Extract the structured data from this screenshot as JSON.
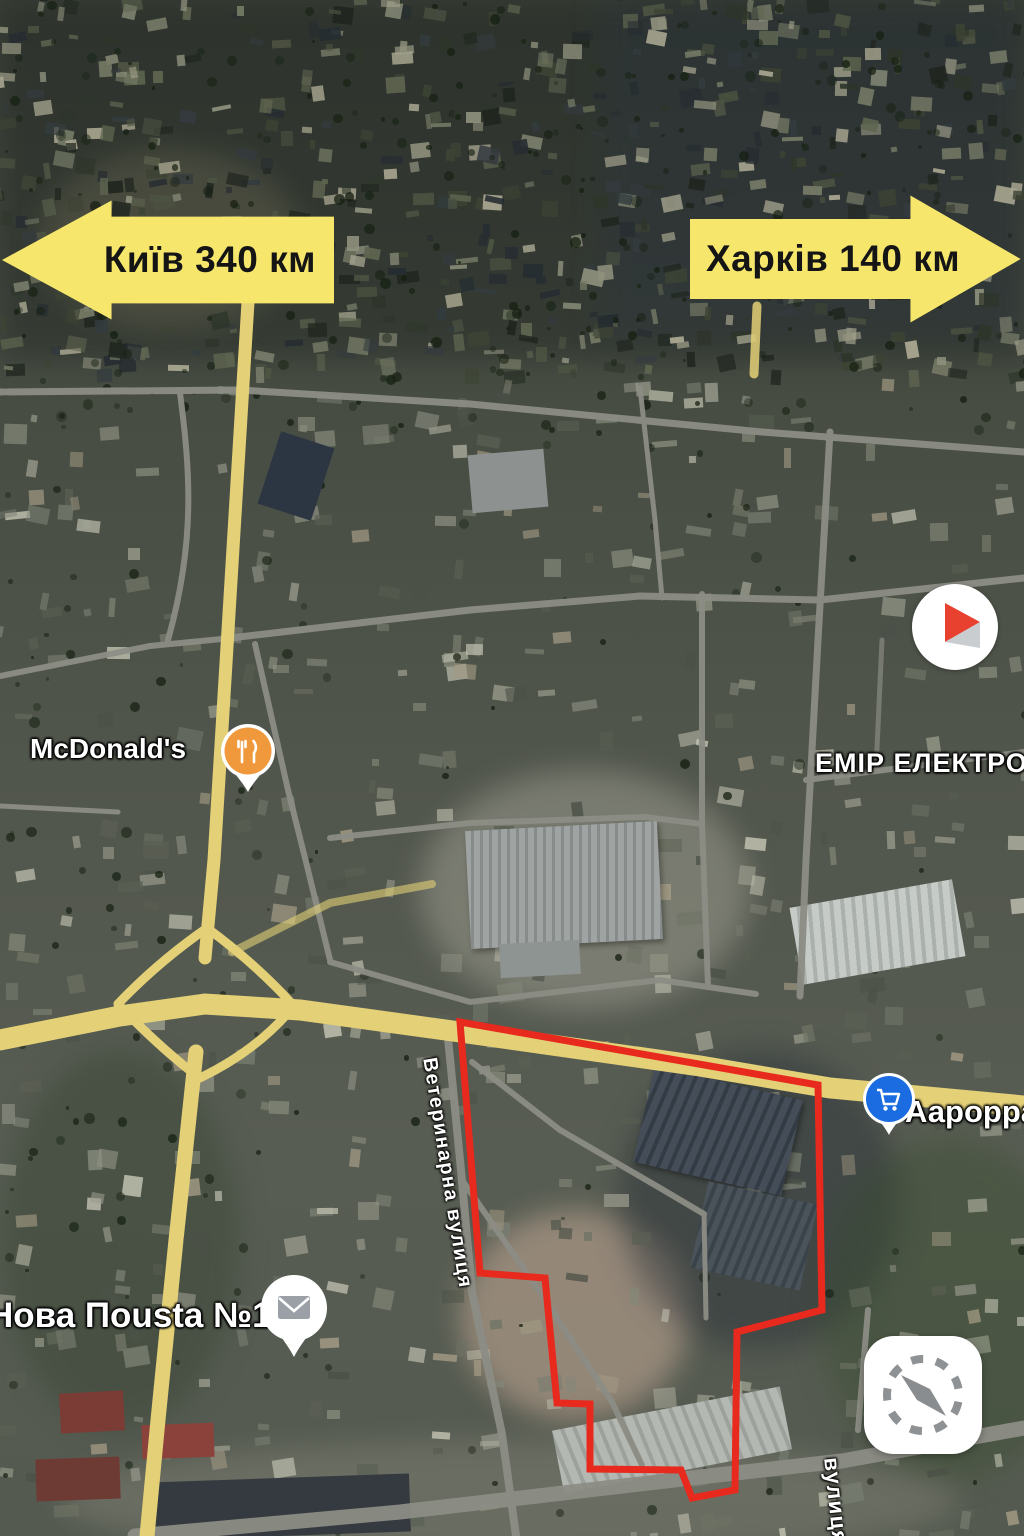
{
  "signs": {
    "kyiv": {
      "label": "Київ 340 км",
      "direction": "left"
    },
    "kharkiv": {
      "label": "Харків 140 км",
      "direction": "right"
    }
  },
  "pois": {
    "mcdonalds": {
      "label": "McDonald's",
      "icon": "restaurant-pin",
      "pin_color": "#f0993c"
    },
    "emir": {
      "label": "ЕМІР ЕЛЕКТРО",
      "icon": "none"
    },
    "nova_poshta": {
      "label": "Нова Поusta №1",
      "icon": "mail-pin",
      "pin_color": "#ffffff"
    },
    "avrora": {
      "label": "Аарорра",
      "icon": "cart-pin",
      "pin_color": "#1b6ce0"
    }
  },
  "streets": {
    "veterynarna": {
      "label": "Ветеринарна вулиця"
    },
    "bottom": {
      "label": "вулиця"
    }
  },
  "markers": {
    "video_marker": {
      "icon": "play-button",
      "color": "#e8412f"
    },
    "compass_widget": {
      "icon": "compass"
    }
  },
  "boundary": {
    "color": "#e8291d",
    "stroke_width": 7,
    "points": "460,1022 818,1085 822,1310 737,1332 735,1490 692,1498 681,1470 590,1469 590,1404 557,1403 545,1278 480,1273"
  },
  "colors": {
    "sign_yellow": "#f6e76c",
    "road_yellow": "#e3d077",
    "road_grey": "#8c8d85",
    "boundary_red": "#e8291d",
    "mcdonalds_orange": "#f0993c",
    "cart_blue": "#1b6ce0",
    "play_red": "#e8412f"
  }
}
